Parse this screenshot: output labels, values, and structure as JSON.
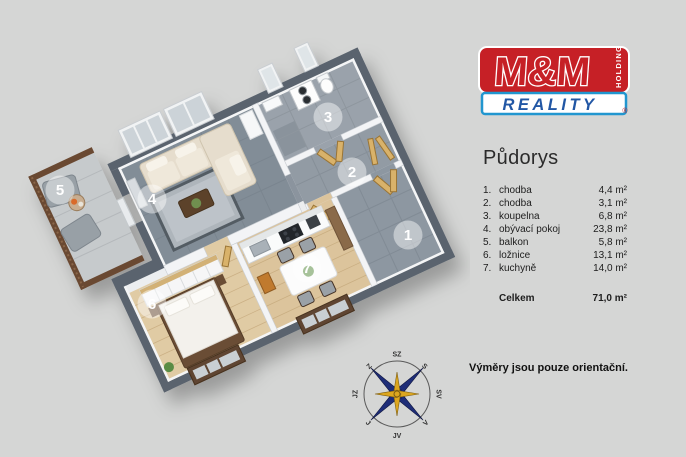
{
  "colors": {
    "background": "#d5d6d5",
    "wall_dark": "#5a636e",
    "partition": "#f3f4f6",
    "floor_tile": "#828d97",
    "floor_wood": "#dcc49c",
    "door_wood": "#d9b26a",
    "logo_red": "#c62026",
    "logo_blue": "#2196cf",
    "reality_text": "#2257a5",
    "compass_navy": "#1e2d78",
    "compass_gold": "#dca61f"
  },
  "logo": {
    "name": "M&M",
    "holding": "HOLDING",
    "reality": "REALITY",
    "registered": "®"
  },
  "legend": {
    "title": "Půdorys",
    "rooms": [
      {
        "num": "1.",
        "name": "chodba",
        "area": "4,4 m²"
      },
      {
        "num": "2.",
        "name": "chodba",
        "area": "3,1 m²"
      },
      {
        "num": "3.",
        "name": "koupelna",
        "area": "6,8 m²"
      },
      {
        "num": "4.",
        "name": "obývací pokoj",
        "area": "23,8 m²"
      },
      {
        "num": "5.",
        "name": "balkon",
        "area": "5,8 m²"
      },
      {
        "num": "6.",
        "name": "ložnice",
        "area": "13,1 m²"
      },
      {
        "num": "7.",
        "name": "kuchyně",
        "area": "14,0 m²"
      }
    ],
    "total_label": "Celkem",
    "total_area": "71,0 m²"
  },
  "floor_plan": {
    "badges": [
      {
        "number": "1",
        "room": "chodba"
      },
      {
        "number": "2",
        "room": "chodba"
      },
      {
        "number": "3",
        "room": "koupelna"
      },
      {
        "number": "4",
        "room": "obývací pokoj"
      },
      {
        "number": "5",
        "room": "balkon"
      },
      {
        "number": "6",
        "room": "ložnice"
      },
      {
        "number": "7",
        "room": "kuchyně"
      }
    ]
  },
  "compass": {
    "n": "S",
    "ne": "SV",
    "e": "V",
    "se": "JV",
    "s": "J",
    "sw": "JZ",
    "w": "Z",
    "nw": "SZ"
  },
  "disclaimer": "Výměry jsou pouze orientační."
}
